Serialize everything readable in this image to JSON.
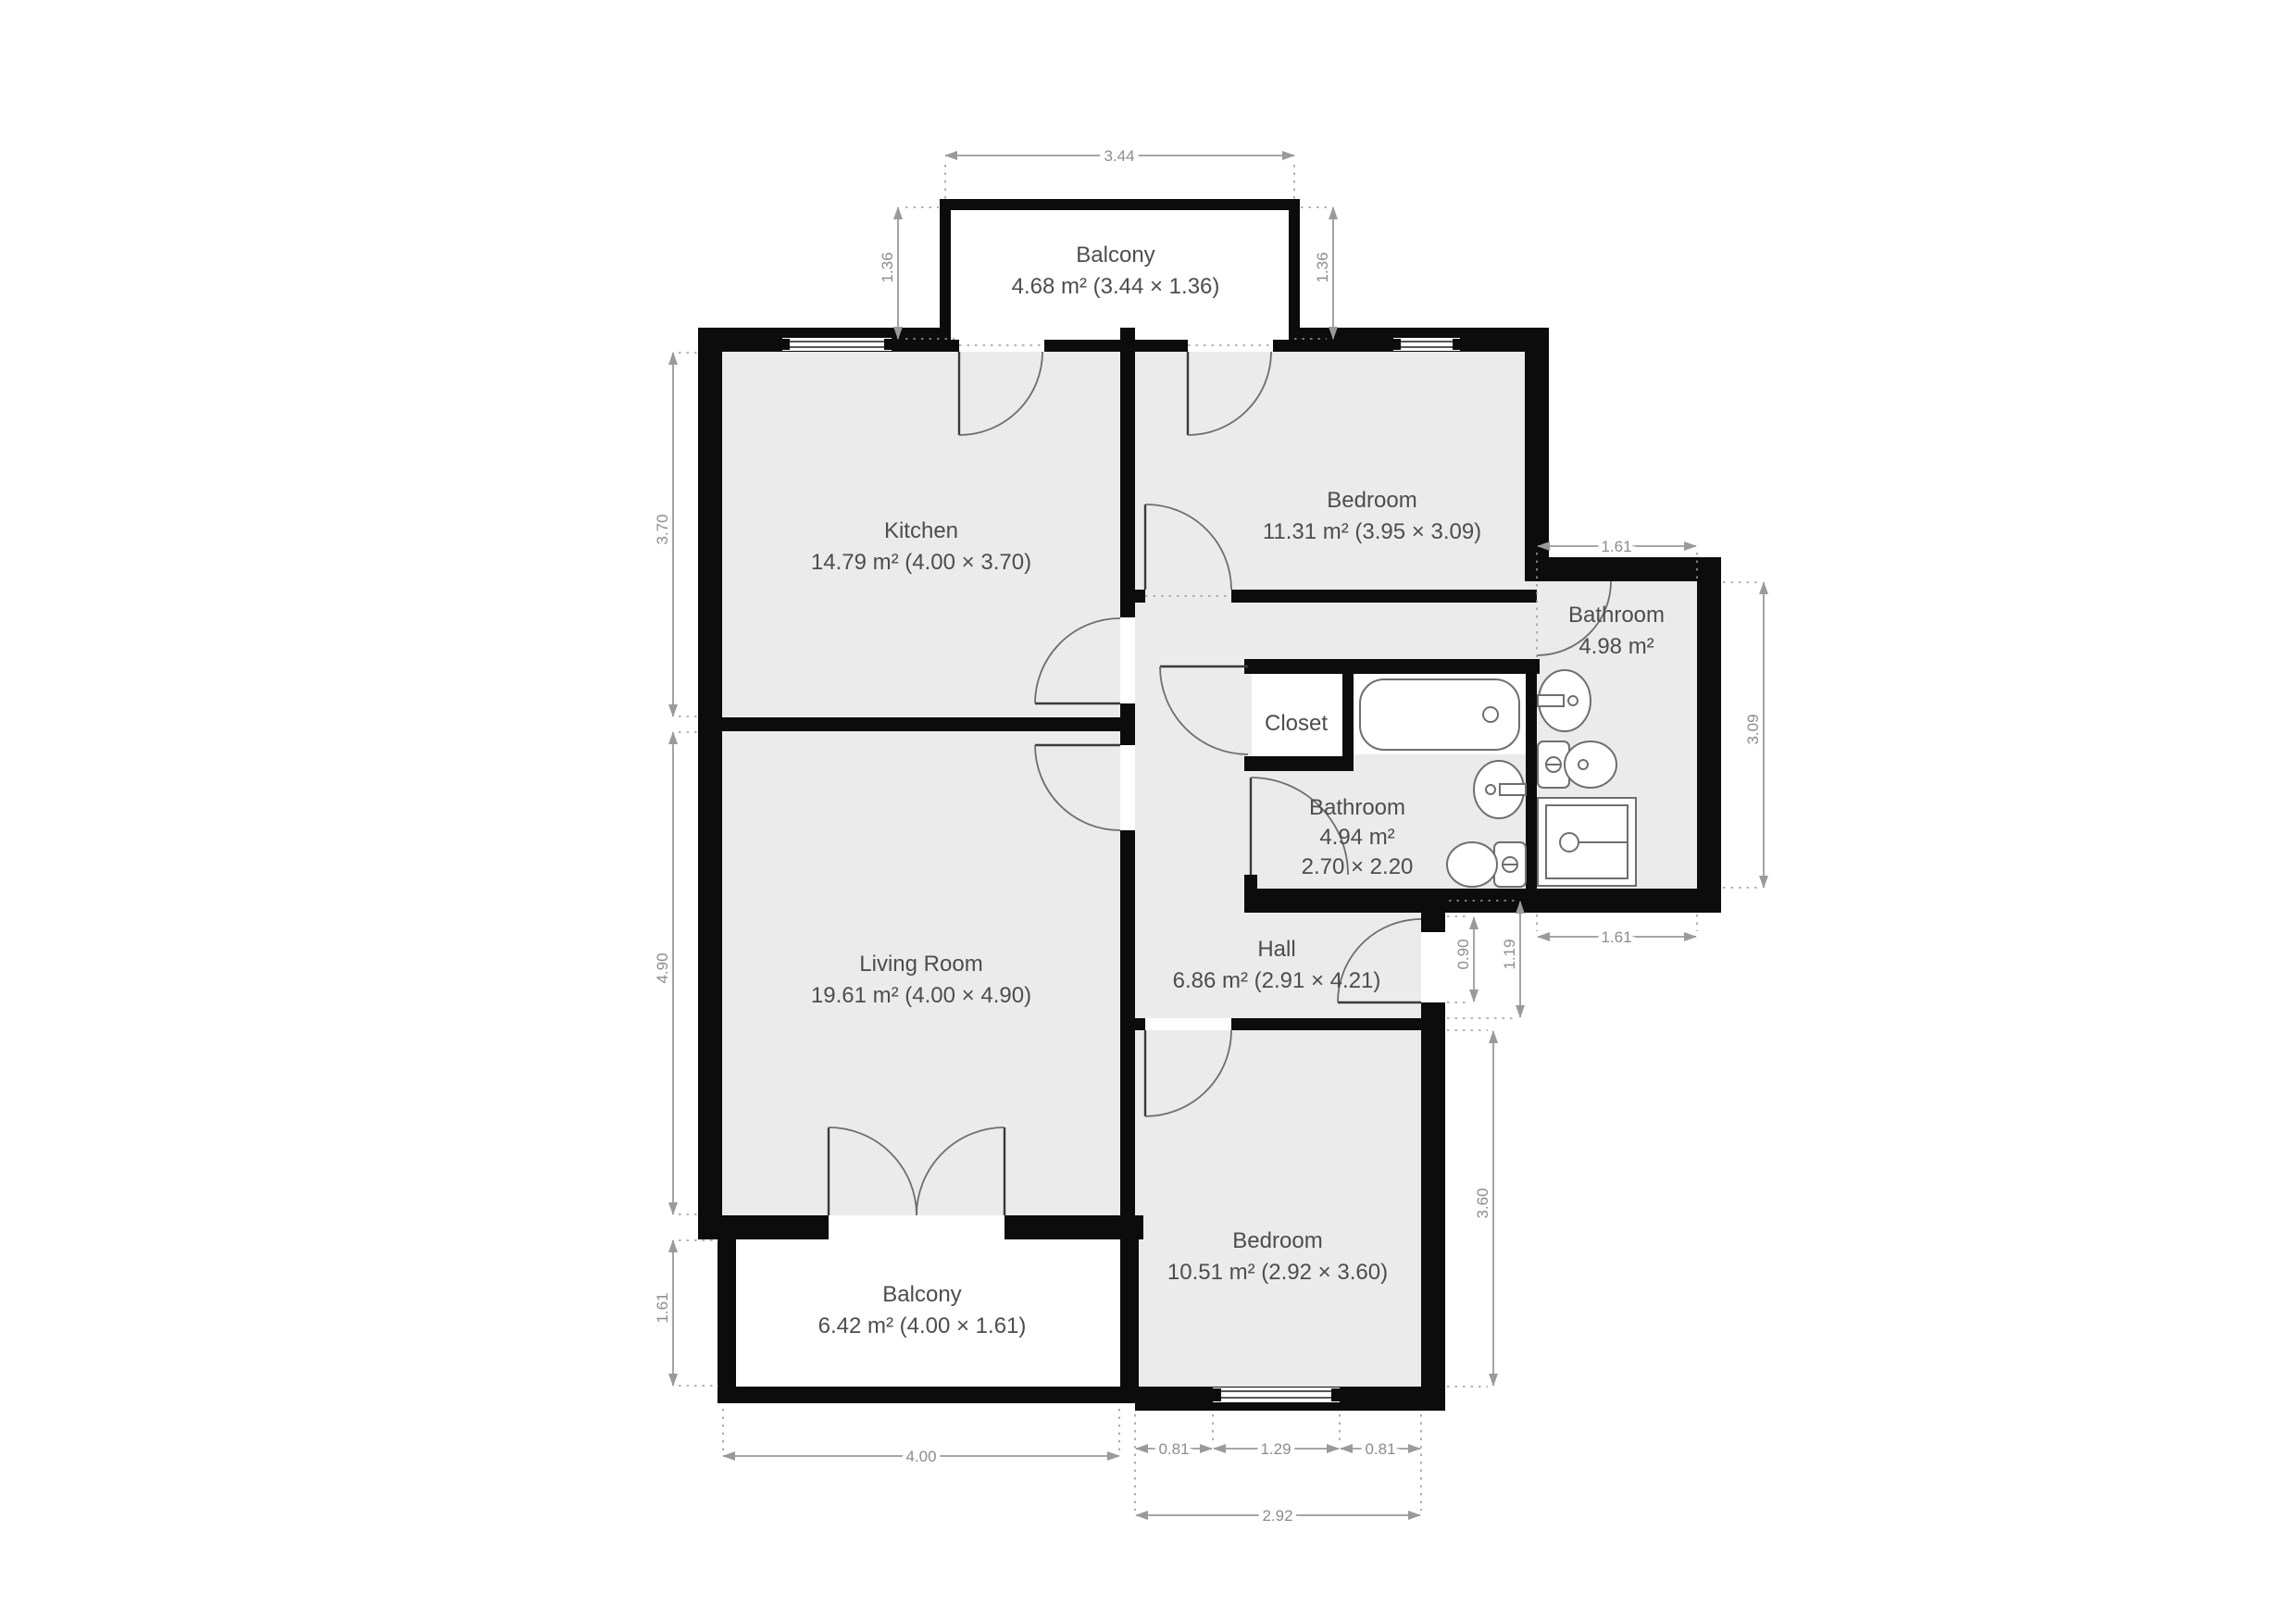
{
  "title": "Apartment floor plan",
  "colors": {
    "wall": "#0c0c0c",
    "floor": "#ebebeb",
    "balcony_floor": "#ffffff",
    "dimension": "#9a9a9a",
    "label": "#4d4d4d"
  },
  "rooms": {
    "balcony_top": {
      "name": "Balcony",
      "area": "4.68 m² (3.44 × 1.36)"
    },
    "kitchen": {
      "name": "Kitchen",
      "area": "14.79 m² (4.00 × 3.70)"
    },
    "bedroom_top": {
      "name": "Bedroom",
      "area": "11.31 m² (3.95 × 3.09)"
    },
    "bathroom_right": {
      "name": "Bathroom",
      "area": "4.98 m²"
    },
    "closet": {
      "name": "Closet"
    },
    "bathroom_mid": {
      "name": "Bathroom",
      "area": "4.94 m²",
      "size": "2.70 × 2.20"
    },
    "living_room": {
      "name": "Living Room",
      "area": "19.61 m² (4.00 × 4.90)"
    },
    "hall": {
      "name": "Hall",
      "area": "6.86 m² (2.91 × 4.21)"
    },
    "bedroom_bottom": {
      "name": "Bedroom",
      "area": "10.51 m² (2.92 × 3.60)"
    },
    "balcony_bottom": {
      "name": "Balcony",
      "area": "6.42 m² (4.00 × 1.61)"
    }
  },
  "dimensions": {
    "balcony_top_width": "3.44",
    "balcony_top_depth_left": "1.36",
    "balcony_top_depth_right": "1.36",
    "kitchen_depth": "3.70",
    "living_depth": "4.90",
    "balcony_bottom_depth": "1.61",
    "balcony_bottom_width": "4.00",
    "bedroom_bottom_seg_left": "0.81",
    "bedroom_bottom_window": "1.29",
    "bedroom_bottom_seg_right": "0.81",
    "bedroom_bottom_width": "2.92",
    "bedroom_bottom_depth": "3.60",
    "bathroom_right_width_top": "1.61",
    "bathroom_right_width_bottom": "1.61",
    "bathroom_right_depth": "3.09",
    "entry_opening": "0.90",
    "entry_offset": "1.19"
  }
}
